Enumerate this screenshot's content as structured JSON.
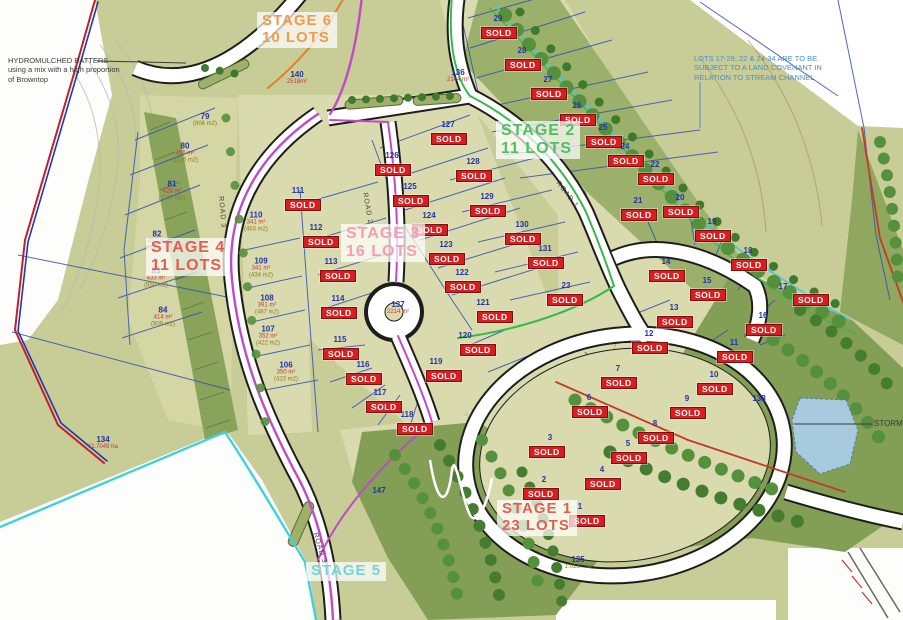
{
  "map": {
    "sold_label": "SOLD",
    "stormwater_label": "STORMW",
    "stages": [
      {
        "id": "stage-6",
        "lines": [
          "STAGE 6",
          "10 LOTS"
        ],
        "color": "#f09a50",
        "x": 257,
        "y": 12,
        "size": 15
      },
      {
        "id": "stage-2",
        "lines": [
          "STAGE 2",
          "11 LOTS"
        ],
        "color": "#4ec15e",
        "x": 496,
        "y": 121,
        "size": 16
      },
      {
        "id": "stage-3",
        "lines": [
          "STAGE 3",
          "16 LOTS"
        ],
        "color": "#f59db5",
        "x": 341,
        "y": 224,
        "size": 16
      },
      {
        "id": "stage-4",
        "lines": [
          "STAGE 4",
          "11 LOTS"
        ],
        "color": "#e55c50",
        "x": 146,
        "y": 238,
        "size": 16
      },
      {
        "id": "stage-1",
        "lines": [
          "STAGE 1",
          "23 LOTS"
        ],
        "color": "#e06050",
        "x": 497,
        "y": 500,
        "size": 15
      },
      {
        "id": "stage-5",
        "lines": [
          "STAGE 5"
        ],
        "color": "#6cd8de",
        "x": 306,
        "y": 562,
        "size": 15
      }
    ],
    "notes": [
      {
        "id": "hydromulch-note",
        "color": "#3a3a3a",
        "x": 8,
        "y": 56,
        "size": 7.5,
        "lines": [
          "HYDROMULCHED BATTERS",
          "using a mix with a high proportion",
          "of Browntop"
        ]
      },
      {
        "id": "covenant-note",
        "color": "#4a90c8",
        "x": 694,
        "y": 54,
        "size": 7.5,
        "lines": [
          "LOTS 17-29, 22 & 24-34 ARE TO BE",
          "SUBJECT TO A LAND COVENANT IN",
          "RELATION TO STREAM CHANNEL"
        ]
      }
    ],
    "road_labels": [
      {
        "text": "ROAD 1",
        "x": 560,
        "y": 180,
        "rot": 52
      },
      {
        "text": "ROAD 2",
        "x": 368,
        "y": 192,
        "rot": 80
      },
      {
        "text": "ROAD 3",
        "x": 224,
        "y": 196,
        "rot": 85
      },
      {
        "text": "ROAD 3",
        "x": 318,
        "y": 532,
        "rot": 72
      }
    ],
    "lots": [
      {
        "n": "29",
        "x": 498,
        "y": 19,
        "sold": true
      },
      {
        "n": "28",
        "x": 522,
        "y": 51,
        "sold": true
      },
      {
        "n": "27",
        "x": 548,
        "y": 80,
        "sold": true
      },
      {
        "n": "26",
        "x": 577,
        "y": 106,
        "sold": true
      },
      {
        "n": "25",
        "x": 603,
        "y": 128,
        "sold": true
      },
      {
        "n": "24",
        "x": 625,
        "y": 147,
        "sold": true
      },
      {
        "n": "22",
        "x": 655,
        "y": 165,
        "sold": true
      },
      {
        "n": "21",
        "x": 638,
        "y": 201,
        "sold": true
      },
      {
        "n": "20",
        "x": 680,
        "y": 198,
        "sold": true
      },
      {
        "n": "19",
        "x": 712,
        "y": 222,
        "sold": true
      },
      {
        "n": "18",
        "x": 748,
        "y": 251,
        "sold": true
      },
      {
        "n": "17",
        "x": 783,
        "y": 287,
        "sold": true,
        "sdx": 10,
        "sdy": 7
      },
      {
        "n": "16",
        "x": 763,
        "y": 316,
        "sold": true
      },
      {
        "n": "15",
        "x": 707,
        "y": 281,
        "sold": true
      },
      {
        "n": "14",
        "x": 666,
        "y": 262,
        "sold": true
      },
      {
        "n": "13",
        "x": 674,
        "y": 308,
        "sold": true
      },
      {
        "n": "12",
        "x": 649,
        "y": 334,
        "sold": true
      },
      {
        "n": "11",
        "x": 734,
        "y": 343,
        "sold": true
      },
      {
        "n": "10",
        "x": 714,
        "y": 375,
        "sold": true
      },
      {
        "n": "9",
        "x": 687,
        "y": 399,
        "sold": true
      },
      {
        "n": "8",
        "x": 655,
        "y": 424,
        "sold": true
      },
      {
        "n": "7",
        "x": 618,
        "y": 369,
        "sold": true
      },
      {
        "n": "6",
        "x": 589,
        "y": 398,
        "sold": true
      },
      {
        "n": "5",
        "x": 628,
        "y": 444,
        "sold": true
      },
      {
        "n": "4",
        "x": 602,
        "y": 470,
        "sold": true
      },
      {
        "n": "3",
        "x": 550,
        "y": 438,
        "sold": true,
        "sdx": -21
      },
      {
        "n": "2",
        "x": 544,
        "y": 480,
        "sold": true,
        "sdx": -21
      },
      {
        "n": "1",
        "x": 580,
        "y": 507,
        "sold": true,
        "sdx": -11
      },
      {
        "n": "23",
        "x": 566,
        "y": 286,
        "sold": true,
        "sdx": -19
      },
      {
        "n": "131",
        "x": 545,
        "y": 249,
        "sold": true
      },
      {
        "n": "130",
        "x": 522,
        "y": 225,
        "sold": true
      },
      {
        "n": "129",
        "x": 487,
        "y": 197,
        "sold": true
      },
      {
        "n": "128",
        "x": 473,
        "y": 162,
        "sold": true
      },
      {
        "n": "127",
        "x": 448,
        "y": 125,
        "sold": true
      },
      {
        "n": "126",
        "x": 392,
        "y": 156,
        "sold": true
      },
      {
        "n": "125",
        "x": 410,
        "y": 187,
        "sold": true
      },
      {
        "n": "124",
        "x": 429,
        "y": 216,
        "sold": true
      },
      {
        "n": "123",
        "x": 446,
        "y": 245,
        "sold": true
      },
      {
        "n": "122",
        "x": 462,
        "y": 273,
        "sold": true
      },
      {
        "n": "121",
        "x": 483,
        "y": 303,
        "sold": true,
        "sdx": -6
      },
      {
        "n": "120",
        "x": 465,
        "y": 336,
        "sold": true,
        "sdx": -5
      },
      {
        "n": "119",
        "x": 436,
        "y": 362,
        "sold": true,
        "sdx": -10
      },
      {
        "n": "118",
        "x": 407,
        "y": 415,
        "sold": true,
        "sdx": -10
      },
      {
        "n": "117",
        "x": 380,
        "y": 393,
        "sold": true,
        "sdx": -14
      },
      {
        "n": "116",
        "x": 363,
        "y": 365,
        "sold": true
      },
      {
        "n": "115",
        "x": 340,
        "y": 340,
        "sold": true
      },
      {
        "n": "114",
        "x": 338,
        "y": 299,
        "sold": true
      },
      {
        "n": "113",
        "x": 331,
        "y": 262,
        "sold": true,
        "sdx": -11
      },
      {
        "n": "112",
        "x": 316,
        "y": 228,
        "sold": true,
        "sdx": -13
      },
      {
        "n": "111",
        "x": 298,
        "y": 191,
        "sold": true,
        "sdx": -13
      },
      {
        "n": "137",
        "x": 398,
        "y": 308,
        "sold": false,
        "areas": [
          {
            "text": "2214 m²",
            "color": "#c23a3a"
          }
        ]
      },
      {
        "n": "110",
        "x": 256,
        "y": 222,
        "sold": false,
        "areas": [
          {
            "text": "341 m²",
            "color": "#c23a3a"
          },
          {
            "text": "(463 m2)",
            "color": "#8a7d1e"
          }
        ]
      },
      {
        "n": "109",
        "x": 261,
        "y": 268,
        "sold": false,
        "areas": [
          {
            "text": "341 m²",
            "color": "#c23a3a"
          },
          {
            "text": "(434 m2)",
            "color": "#8a7d1e"
          }
        ]
      },
      {
        "n": "108",
        "x": 267,
        "y": 305,
        "sold": false,
        "areas": [
          {
            "text": "391 m²",
            "color": "#c23a3a"
          },
          {
            "text": "(467 m2)",
            "color": "#8a7d1e"
          }
        ]
      },
      {
        "n": "107",
        "x": 268,
        "y": 336,
        "sold": false,
        "areas": [
          {
            "text": "352 m²",
            "color": "#c23a3a"
          },
          {
            "text": "(422 m2)",
            "color": "#8a7d1e"
          }
        ]
      },
      {
        "n": "106",
        "x": 286,
        "y": 372,
        "sold": false,
        "areas": [
          {
            "text": "350 m²",
            "color": "#c23a3a"
          },
          {
            "text": "(423 m2)",
            "color": "#8a7d1e"
          }
        ]
      },
      {
        "n": "79",
        "x": 205,
        "y": 120,
        "sold": false,
        "areas": [
          {
            "text": "(806 m2)",
            "color": "#8a7d1e"
          }
        ]
      },
      {
        "n": "80",
        "x": 185,
        "y": 153,
        "sold": false,
        "areas": [
          {
            "text": "456 m²",
            "color": "#c23a3a"
          },
          {
            "text": "(1116 m2)",
            "color": "#8a7d1e"
          }
        ]
      },
      {
        "n": "81",
        "x": 172,
        "y": 191,
        "sold": false,
        "areas": [
          {
            "text": "428 m²",
            "color": "#c23a3a"
          },
          {
            "text": "(1107 m2)",
            "color": "#8a7d1e"
          }
        ]
      },
      {
        "n": "82",
        "x": 157,
        "y": 241,
        "sold": false,
        "areas": [
          {
            "text": "422 m²",
            "color": "#c23a3a"
          },
          {
            "text": "(839 m2)",
            "color": "#8a7d1e"
          }
        ]
      },
      {
        "n": "83",
        "x": 156,
        "y": 278,
        "sold": false,
        "areas": [
          {
            "text": "433 m²",
            "color": "#c23a3a"
          },
          {
            "text": "(850 m2)",
            "color": "#8a7d1e"
          }
        ]
      },
      {
        "n": "84",
        "x": 163,
        "y": 317,
        "sold": false,
        "areas": [
          {
            "text": "414 m²",
            "color": "#c23a3a"
          },
          {
            "text": "(809 m2)",
            "color": "#8a7d1e"
          }
        ]
      },
      {
        "n": "134",
        "x": 103,
        "y": 443,
        "sold": false,
        "areas": [
          {
            "text": "11.7049 ha",
            "color": "#c23a3a"
          }
        ]
      },
      {
        "n": "135",
        "x": 578,
        "y": 563,
        "sold": false,
        "areas": [
          {
            "text": "1.0137 ha",
            "color": "#8a7d1e"
          }
        ]
      },
      {
        "n": "136",
        "x": 458,
        "y": 76,
        "sold": false,
        "areas": [
          {
            "text": "2144 m²",
            "color": "#c23a3a"
          }
        ]
      },
      {
        "n": "140",
        "x": 297,
        "y": 78,
        "sold": false,
        "areas": [
          {
            "text": "2518m²",
            "color": "#c23a3a"
          }
        ]
      },
      {
        "n": "147",
        "x": 379,
        "y": 491,
        "sold": false
      },
      {
        "n": "138",
        "x": 759,
        "y": 399,
        "sold": false
      }
    ]
  }
}
